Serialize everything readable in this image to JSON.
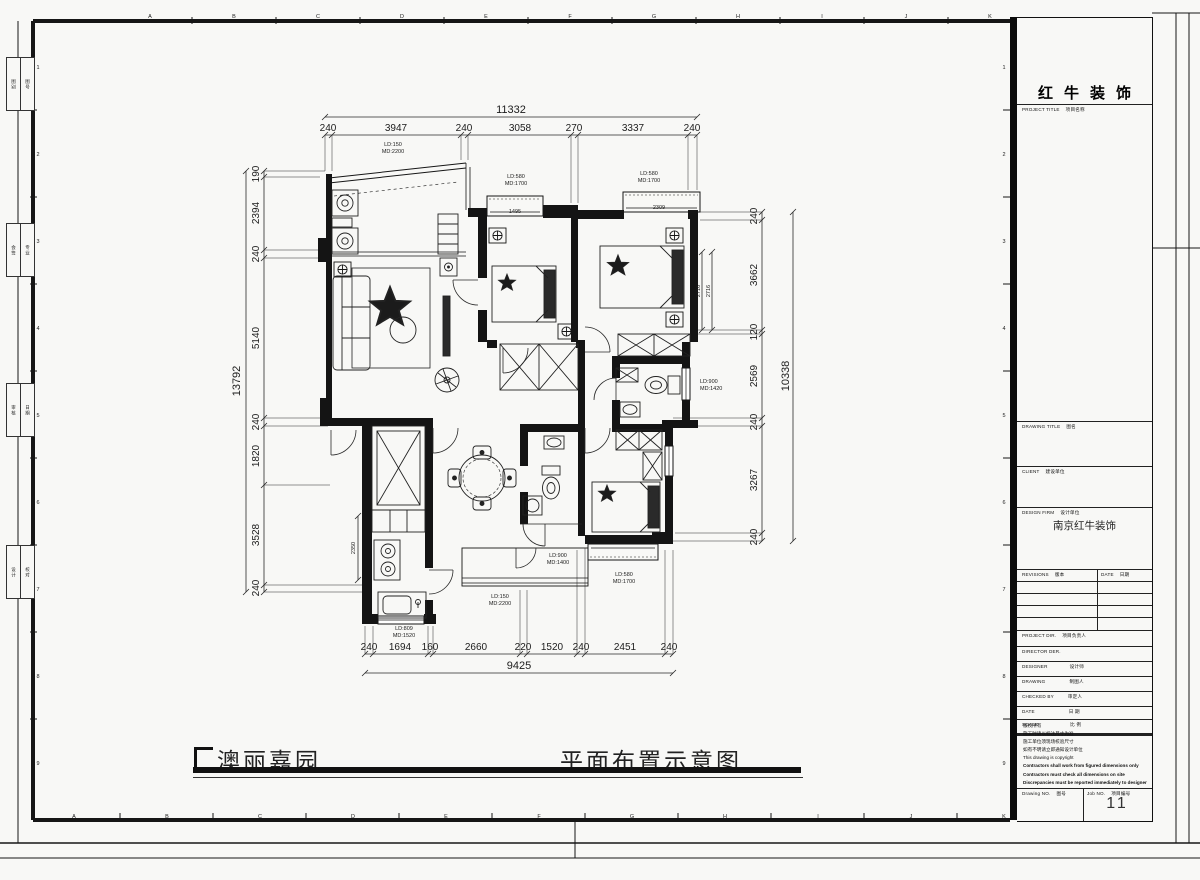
{
  "sheet": {
    "grid_letters": [
      "A",
      "B",
      "C",
      "D",
      "E",
      "F",
      "G",
      "H",
      "I",
      "J",
      "K"
    ],
    "grid_numbers": [
      "1",
      "2",
      "3",
      "4",
      "5",
      "6",
      "7",
      "8",
      "9"
    ],
    "margin_boxes": [
      [
        "图别",
        "图号"
      ],
      [
        "会签",
        "专业"
      ],
      [
        "审核",
        "日期"
      ],
      [
        "设计",
        "校对"
      ]
    ]
  },
  "footer": {
    "project_title": "澳丽嘉园",
    "drawing_title": "平面布置示意图"
  },
  "title_block": {
    "company_name": "红牛装饰",
    "project_title_label": "PROJECT TITLE",
    "project_title_cn": "项目名称",
    "drawing_title_label": "DRAWING TITLE",
    "drawing_title_cn": "图名",
    "client_label": "CLIENT",
    "client_cn": "建设单位",
    "design_firm_label": "DESIGN FIRM",
    "design_firm_cn": "设计单位",
    "design_firm_value": "南京红牛装饰",
    "revisions_label": "REVISIONS",
    "revisions_cn": "版本",
    "date_label": "DATE",
    "date_cn": "日期",
    "project_dir_label": "PROJECT DIR.",
    "project_dir_cn": "项目负责人",
    "director_label": "DIRECTOR DER.",
    "designer_label": "DESIGNER",
    "designer_cn": "设计师",
    "drawing_label": "DRAWING",
    "drawing_cn": "制图人",
    "checked_label": "CHECKED BY",
    "checked_cn": "审定人",
    "date2_label": "DATE",
    "date2_cn": "日 期",
    "scale_label": "SCALE",
    "scale_cn": "比 例",
    "copyright_lines": [
      "版权所有",
      "施工时请以标注尺寸为准",
      "施工单位须现场校验尺寸",
      "如有不明请立即通知设计单位",
      "This drawing is copyright",
      "Contractors shall work from figured dimensions only",
      "Contractors must check all dimensions on site",
      "Discrepancies must be reported immediately to designer"
    ],
    "drawing_no_label": "Drawing NO.",
    "drawing_no_cn": "图号",
    "job_no_label": "Job NO.",
    "job_no_cn": "项目编号",
    "job_no_value": "11"
  },
  "plan": {
    "dims": {
      "top": {
        "total": "11332",
        "segments": [
          "240",
          "3947",
          "240",
          "3058",
          "270",
          "3337",
          "240"
        ]
      },
      "left": {
        "total": "13792",
        "segments": [
          "190",
          "2394",
          "240",
          "5140",
          "240",
          "1820",
          "3528",
          "240"
        ]
      },
      "right": {
        "total": "10338",
        "segments": [
          "240",
          "3662",
          "120",
          "2569",
          "240",
          "3267",
          "240"
        ]
      },
      "bottom": {
        "total": "9425",
        "segments": [
          "240",
          "1694",
          "160",
          "2660",
          "220",
          "1520",
          "240",
          "2451",
          "240"
        ]
      }
    },
    "window_labels": {
      "tl": [
        "LD:150",
        "MD:2200"
      ],
      "tm": [
        "LD:580",
        "MD:1700"
      ],
      "tr": [
        "LD:580",
        "MD:1700"
      ],
      "right": [
        "LD:900",
        "MD:1420"
      ],
      "center": [
        "LD:900",
        "MD:1400"
      ],
      "utility": [
        "LD:150",
        "MD:2200"
      ],
      "br": [
        "LD:580",
        "MD:1700"
      ],
      "kitchen": [
        "LD:809",
        "MD:1520"
      ]
    },
    "inner_dims": {
      "window_tm": "1495",
      "window_tr": "2309",
      "bed": "2716",
      "kitchen_depth": "2350"
    }
  }
}
